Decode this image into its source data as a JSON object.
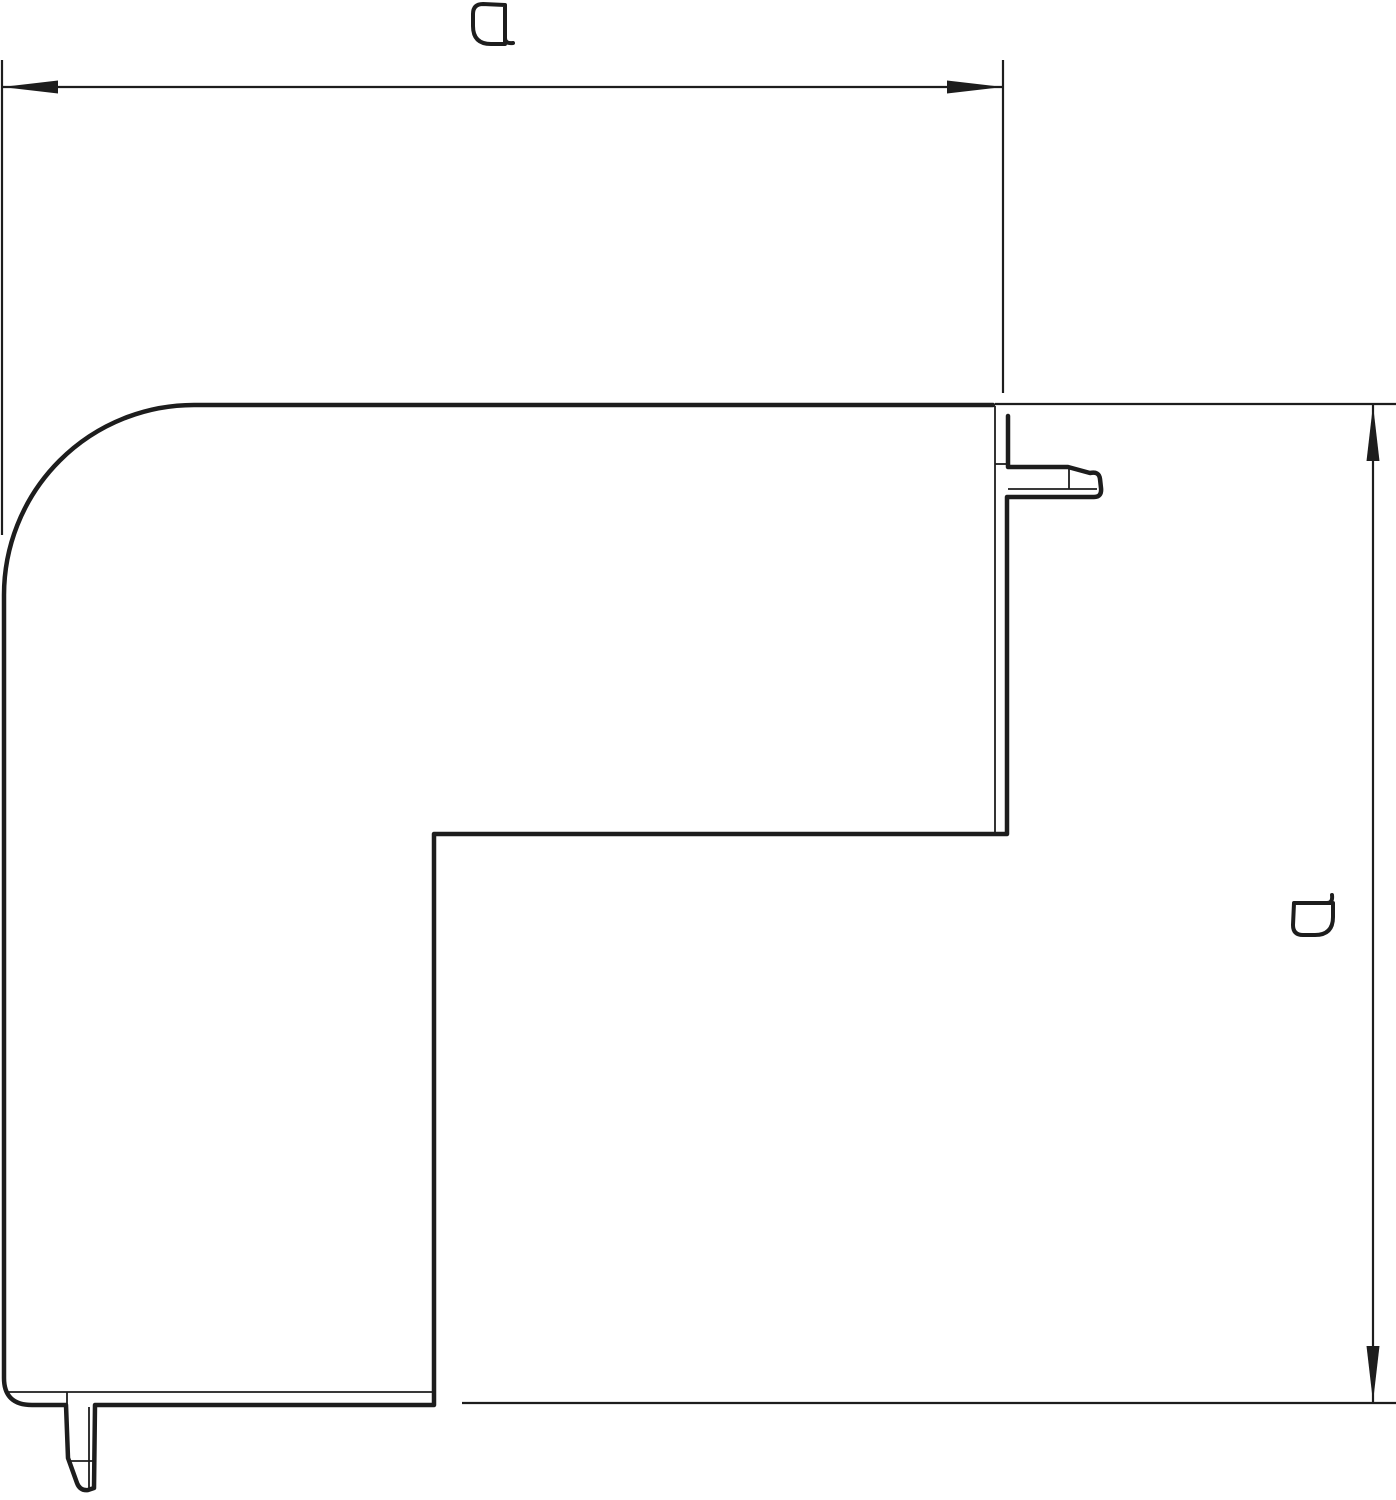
{
  "page": {
    "background": "#ffffff"
  },
  "drawing": {
    "name": "flat-corner-cover-dimension-drawing",
    "kind": "technical line drawing, 90-degree flat angle profile with snap tabs",
    "stroke_color": "#1d1d1d",
    "dimensions": {
      "horizontal": {
        "label": "a",
        "position": "top",
        "orientation": "horizontal"
      },
      "vertical": {
        "label": "a",
        "position": "right",
        "orientation": "vertical"
      }
    }
  }
}
